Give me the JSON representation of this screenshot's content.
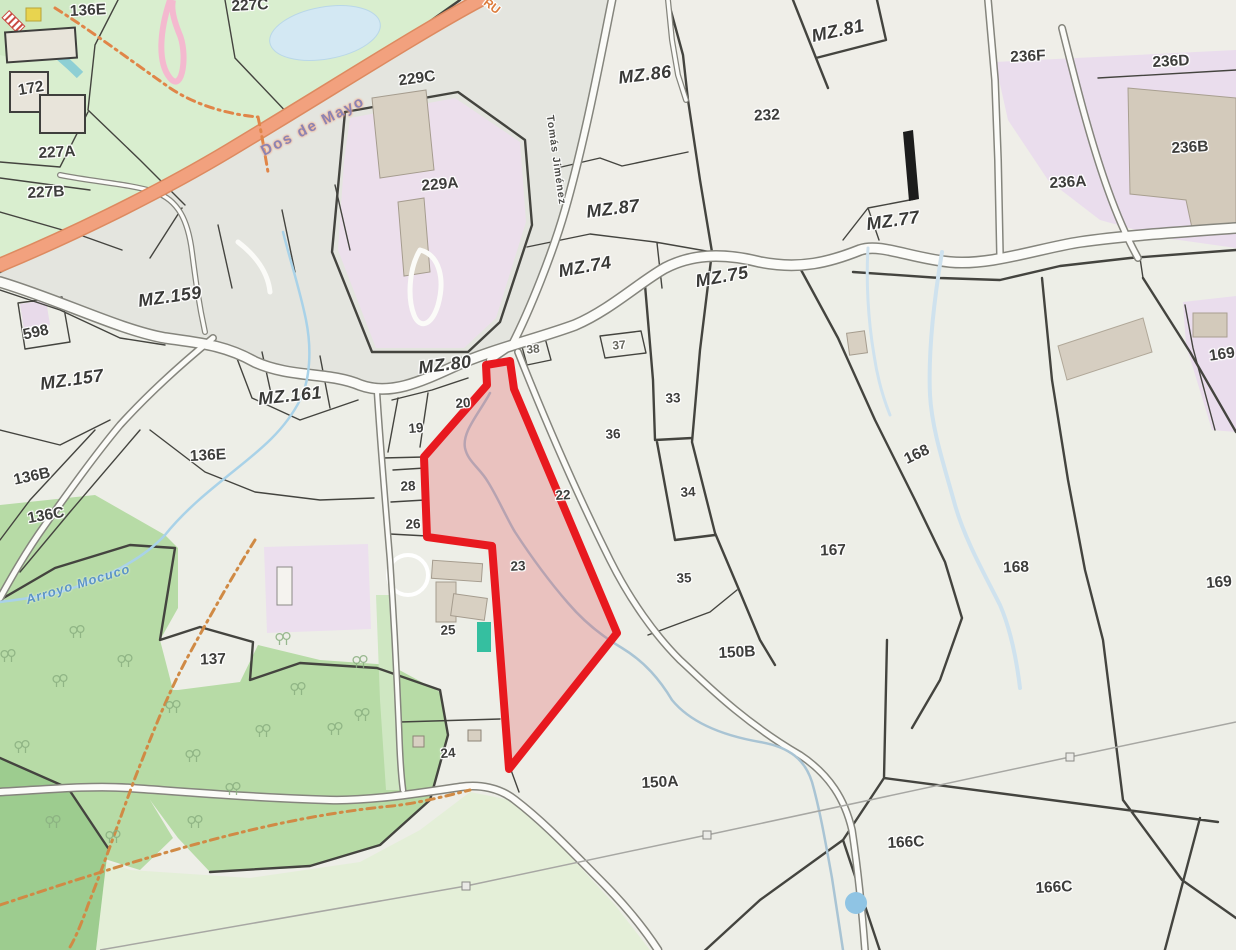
{
  "map": {
    "description": "Cadastral parcel map with block (MZ) and lot labels, one lot highlighted in red",
    "highlight": {
      "parcel_number": "23",
      "stroke_color": "#e8191f",
      "fill_color": "rgba(228,62,72,0.25)"
    },
    "colors": {
      "background": "#edeee7",
      "park_green": "#d9eecf",
      "forest_green": "#b7dba6",
      "field_green": "#e4efd8",
      "dark_green": "#9dcc8f",
      "lavender_zone": "#ecdfec",
      "orange_road": "#f2a17e",
      "road_fill": "#fbfbf8",
      "road_casing": "#85857d",
      "water_blue": "#a9d2e8",
      "boundary_dark": "#44443f",
      "building_tan": "#d8d0c2",
      "trail_orange": "#d08a45",
      "admin_gray": "#a7a7a3"
    },
    "block_labels": [
      {
        "t": "MZ.159",
        "x": 170,
        "y": 297,
        "r": -8,
        "c": "mz"
      },
      {
        "t": "MZ.157",
        "x": 72,
        "y": 380,
        "r": -8,
        "c": "mz"
      },
      {
        "t": "MZ.161",
        "x": 290,
        "y": 396,
        "r": -6,
        "c": "mz"
      },
      {
        "t": "MZ.80",
        "x": 445,
        "y": 365,
        "r": -7,
        "c": "mz"
      },
      {
        "t": "MZ.86",
        "x": 645,
        "y": 75,
        "r": -7,
        "c": "mz"
      },
      {
        "t": "MZ.87",
        "x": 613,
        "y": 209,
        "r": -7,
        "c": "mz"
      },
      {
        "t": "MZ.74",
        "x": 585,
        "y": 267,
        "r": -10,
        "c": "mz"
      },
      {
        "t": "MZ.75",
        "x": 722,
        "y": 277,
        "r": -10,
        "c": "mz"
      },
      {
        "t": "MZ.77",
        "x": 893,
        "y": 221,
        "r": -8,
        "c": "mz"
      },
      {
        "t": "MZ.81",
        "x": 838,
        "y": 31,
        "r": -12,
        "c": "mz"
      }
    ],
    "parcel_labels": [
      {
        "t": "136E",
        "x": 88,
        "y": 11,
        "r": -3,
        "c": "num"
      },
      {
        "t": "227C",
        "x": 250,
        "y": 6,
        "r": -3,
        "c": "num"
      },
      {
        "t": "172",
        "x": 31,
        "y": 89,
        "r": -10,
        "c": "num"
      },
      {
        "t": "227A",
        "x": 57,
        "y": 153,
        "r": -3,
        "c": "num"
      },
      {
        "t": "227B",
        "x": 46,
        "y": 193,
        "r": -3,
        "c": "num"
      },
      {
        "t": "229C",
        "x": 417,
        "y": 79,
        "r": -8,
        "c": "num"
      },
      {
        "t": "229A",
        "x": 440,
        "y": 185,
        "r": -5,
        "c": "num"
      },
      {
        "t": "232",
        "x": 767,
        "y": 116,
        "r": -3,
        "c": "num"
      },
      {
        "t": "236F",
        "x": 1028,
        "y": 57,
        "r": -3,
        "c": "num"
      },
      {
        "t": "236D",
        "x": 1171,
        "y": 62,
        "r": -3,
        "c": "num"
      },
      {
        "t": "236B",
        "x": 1190,
        "y": 148,
        "r": -3,
        "c": "num"
      },
      {
        "t": "236A",
        "x": 1068,
        "y": 183,
        "r": -3,
        "c": "num"
      },
      {
        "t": "598",
        "x": 36,
        "y": 333,
        "r": -12,
        "c": "num"
      },
      {
        "t": "136B",
        "x": 32,
        "y": 477,
        "r": -12,
        "c": "num"
      },
      {
        "t": "136C",
        "x": 46,
        "y": 516,
        "r": -10,
        "c": "num"
      },
      {
        "t": "136E",
        "x": 208,
        "y": 456,
        "r": -3,
        "c": "num"
      },
      {
        "t": "137",
        "x": 213,
        "y": 660,
        "r": -2,
        "c": "num"
      },
      {
        "t": "19",
        "x": 416,
        "y": 428,
        "r": -5,
        "c": "sm"
      },
      {
        "t": "20",
        "x": 463,
        "y": 403,
        "r": -5,
        "c": "sm"
      },
      {
        "t": "28",
        "x": 408,
        "y": 486,
        "r": -3,
        "c": "sm"
      },
      {
        "t": "26",
        "x": 413,
        "y": 524,
        "r": -3,
        "c": "sm"
      },
      {
        "t": "23",
        "x": 518,
        "y": 566,
        "r": -3,
        "c": "sm"
      },
      {
        "t": "22",
        "x": 563,
        "y": 495,
        "r": -3,
        "c": "sm"
      },
      {
        "t": "25",
        "x": 448,
        "y": 630,
        "r": -3,
        "c": "sm"
      },
      {
        "t": "24",
        "x": 448,
        "y": 753,
        "r": -5,
        "c": "sm"
      },
      {
        "t": "36",
        "x": 613,
        "y": 434,
        "r": -3,
        "c": "sm"
      },
      {
        "t": "33",
        "x": 673,
        "y": 398,
        "r": -3,
        "c": "sm"
      },
      {
        "t": "34",
        "x": 688,
        "y": 492,
        "r": -3,
        "c": "sm"
      },
      {
        "t": "35",
        "x": 684,
        "y": 578,
        "r": -3,
        "c": "sm"
      },
      {
        "t": "38",
        "x": 533,
        "y": 349,
        "r": -5,
        "c": "tiny"
      },
      {
        "t": "37",
        "x": 619,
        "y": 345,
        "r": -5,
        "c": "tiny"
      },
      {
        "t": "150B",
        "x": 737,
        "y": 653,
        "r": -3,
        "c": "num"
      },
      {
        "t": "167",
        "x": 833,
        "y": 551,
        "r": -2,
        "c": "num"
      },
      {
        "t": "168",
        "x": 917,
        "y": 455,
        "r": -25,
        "c": "num"
      },
      {
        "t": "168",
        "x": 1016,
        "y": 568,
        "r": -2,
        "c": "num"
      },
      {
        "t": "169",
        "x": 1222,
        "y": 355,
        "r": -8,
        "c": "num"
      },
      {
        "t": "169",
        "x": 1219,
        "y": 583,
        "r": -5,
        "c": "num"
      },
      {
        "t": "150A",
        "x": 660,
        "y": 783,
        "r": -3,
        "c": "num"
      },
      {
        "t": "166C",
        "x": 906,
        "y": 843,
        "r": -3,
        "c": "num"
      },
      {
        "t": "166C",
        "x": 1054,
        "y": 888,
        "r": -3,
        "c": "num"
      }
    ],
    "street_labels": [
      {
        "t": "Dos de Mayo",
        "x": 313,
        "y": 126,
        "r": -27,
        "c": "street"
      },
      {
        "t": "Tomás Jiménez",
        "x": 556,
        "y": 160,
        "r": 82,
        "c": "vstreet"
      },
      {
        "t": "Arroyo Mocuco",
        "x": 78,
        "y": 584,
        "r": -17,
        "c": "water"
      },
      {
        "t": "RU",
        "x": 492,
        "y": 6,
        "r": 38,
        "c": "route"
      }
    ],
    "trees": [
      [
        77,
        633
      ],
      [
        125,
        662
      ],
      [
        60,
        682
      ],
      [
        173,
        708
      ],
      [
        263,
        732
      ],
      [
        298,
        690
      ],
      [
        360,
        663
      ],
      [
        193,
        757
      ],
      [
        233,
        790
      ],
      [
        113,
        838
      ],
      [
        53,
        823
      ],
      [
        335,
        730
      ],
      [
        195,
        823
      ],
      [
        362,
        716
      ],
      [
        8,
        657
      ],
      [
        22,
        748
      ],
      [
        283,
        640
      ]
    ]
  }
}
